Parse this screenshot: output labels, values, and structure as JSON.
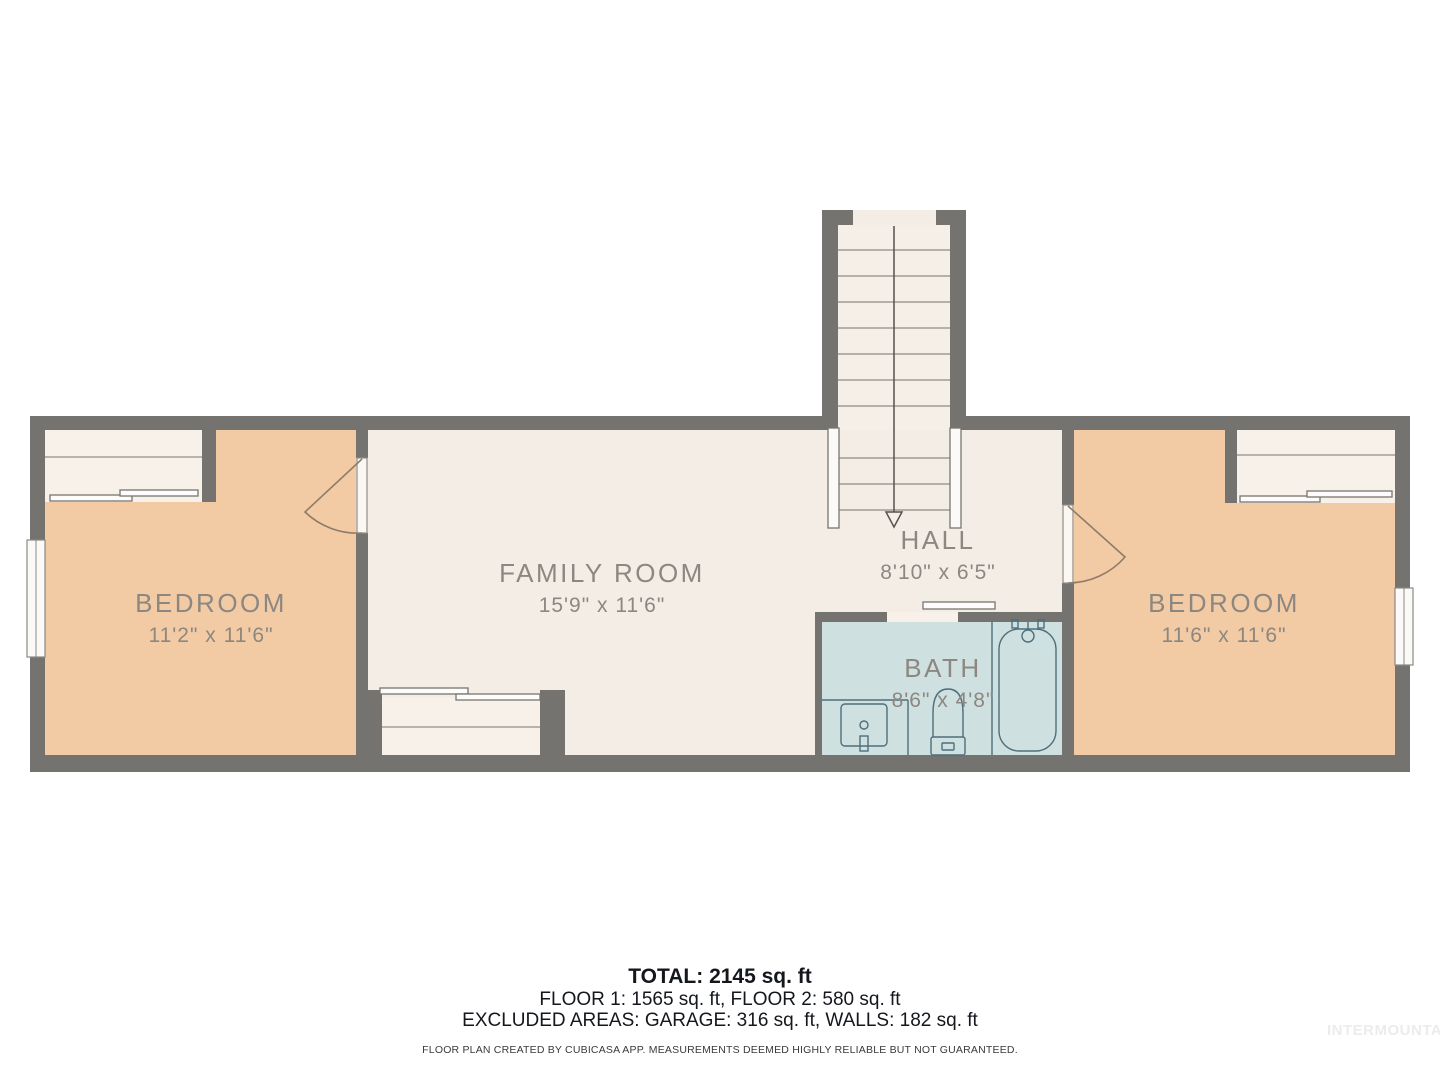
{
  "plan": {
    "rooms": {
      "bedroom_left": {
        "name": "BEDROOM",
        "dims": "11'2\" x 11'6\""
      },
      "family_room": {
        "name": "FAMILY ROOM",
        "dims": "15'9\" x 11'6\""
      },
      "hall": {
        "name": "HALL",
        "dims": "8'10\" x 6'5\""
      },
      "bath": {
        "name": "BATH",
        "dims": "8'6\" x 4'8\""
      },
      "bedroom_right": {
        "name": "BEDROOM",
        "dims": "11'6\" x 11'6\""
      }
    },
    "features": [
      "stairs-down",
      "closet-left",
      "closet-family",
      "closet-right",
      "bathtub",
      "toilet",
      "sink",
      "windows"
    ],
    "colors": {
      "wall": "#757370",
      "bedroom_fill": "#f2cba5",
      "living_fill": "#f4ede6",
      "closet_fill": "#f7f1ea",
      "bath_fill": "#cfe0e0",
      "fixture_stroke": "#4e6e7a",
      "label_text": "#8d8781",
      "footer_text": "#14171c",
      "watermark_text": "#ebeceb"
    }
  },
  "footer": {
    "total": "TOTAL: 2145 sq. ft",
    "floors": "FLOOR 1: 1565 sq. ft, FLOOR 2: 580 sq. ft",
    "excluded": "EXCLUDED AREAS: GARAGE: 316 sq. ft, WALLS: 182 sq. ft",
    "disclaimer": "FLOOR PLAN CREATED BY CUBICASA APP. MEASUREMENTS DEEMED HIGHLY RELIABLE BUT NOT GUARANTEED."
  },
  "watermark": "INTERMOUNTAIN"
}
